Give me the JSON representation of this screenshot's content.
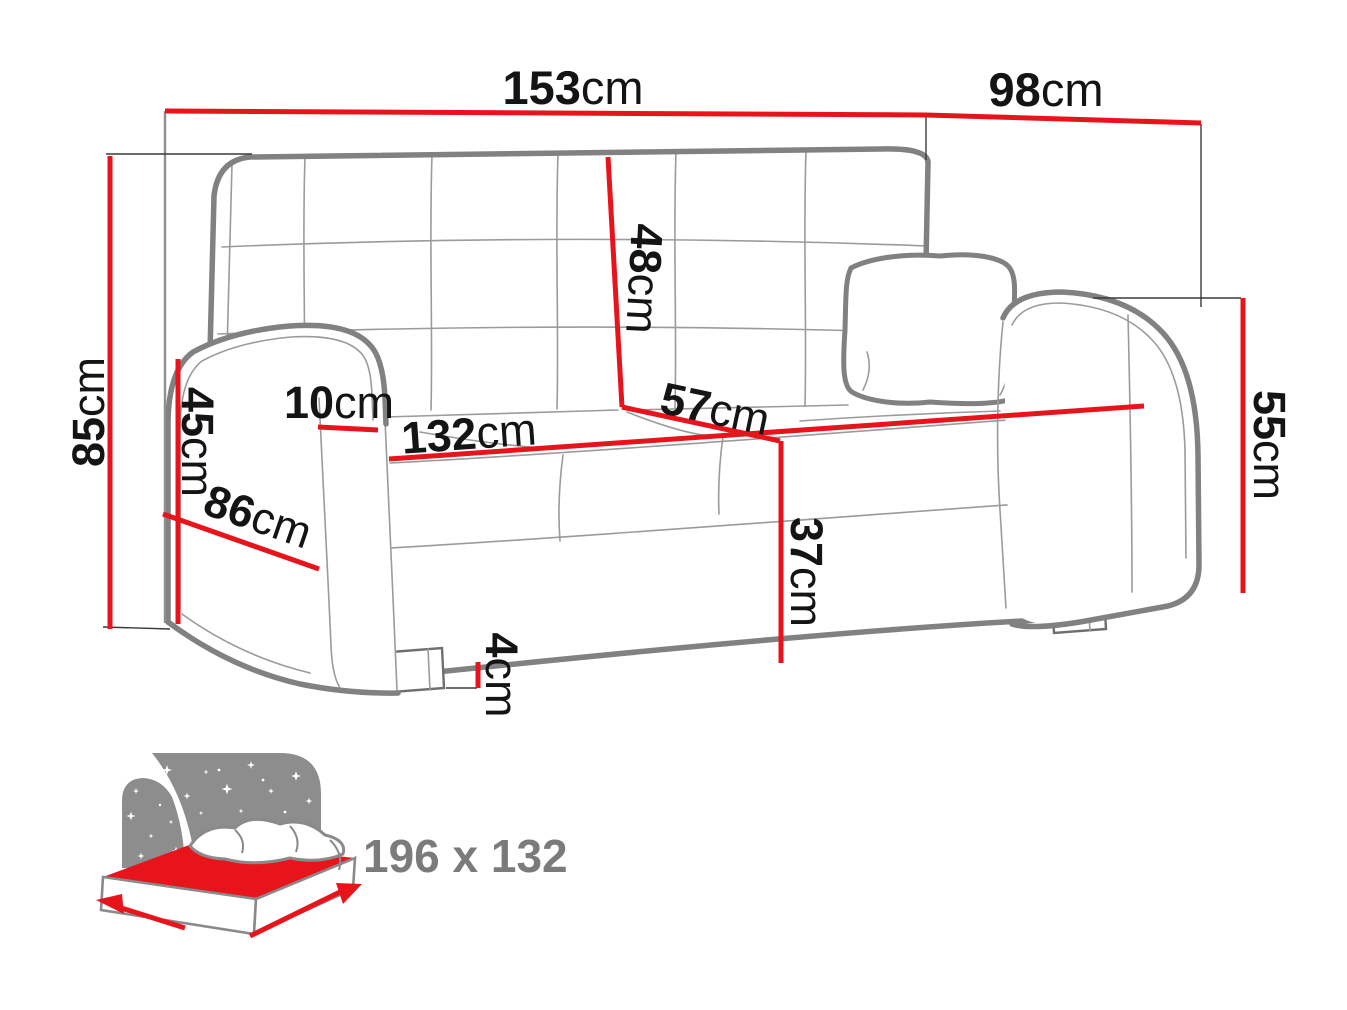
{
  "diagram": {
    "type": "sofa-dimension-drawing",
    "unit": "cm",
    "colors": {
      "dimension_line": "#e8141c",
      "sofa_outline": "#818181",
      "label_text": "#141414",
      "bed_icon_gray": "#8d8d8d",
      "bed_label_text": "#7b7b7b"
    },
    "dimensions": {
      "overall_width": {
        "value": "153",
        "unit": "cm"
      },
      "overall_depth": {
        "value": "98",
        "unit": "cm"
      },
      "overall_height": {
        "value": "85",
        "unit": "cm"
      },
      "armrest_height": {
        "value": "45",
        "unit": "cm"
      },
      "armrest_width": {
        "value": "10",
        "unit": "cm"
      },
      "seat_width": {
        "value": "132",
        "unit": "cm"
      },
      "armrest_depth": {
        "value": "86",
        "unit": "cm"
      },
      "backrest_height": {
        "value": "48",
        "unit": "cm"
      },
      "seat_depth": {
        "value": "57",
        "unit": "cm"
      },
      "side_height": {
        "value": "55",
        "unit": "cm"
      },
      "seat_height": {
        "value": "37",
        "unit": "cm"
      },
      "leg_height": {
        "value": "4",
        "unit": "cm"
      }
    },
    "sleeping_area": {
      "label": "196 x 132"
    }
  }
}
